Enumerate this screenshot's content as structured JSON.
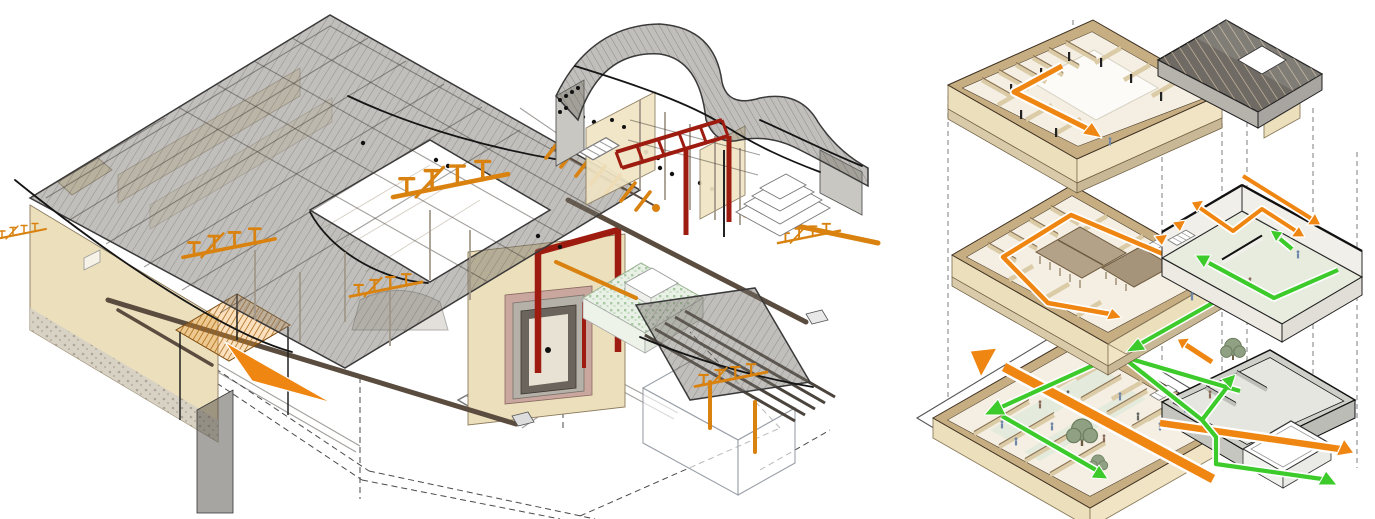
{
  "canvas": {
    "width": 1375,
    "height": 519,
    "viewbox": "0 0 1375 519"
  },
  "figures": {
    "left": {
      "id": "cutaway-axonometric",
      "kind": "sectional cutaway axonometric of a courtyard building",
      "elements": [
        "wireframe-tiled-roof",
        "tan-masonry-walls",
        "pebble-wall-base",
        "orange-timber-bracket-inserts",
        "orange-slatted-canopy",
        "orange-ramp",
        "dark-red-steel-frames",
        "green-mosaic-flat-roof",
        "ornamental-gate-wall",
        "curved-roof-hall",
        "stepped-plinth",
        "glass-gatehouse",
        "dashed-site-outline"
      ]
    },
    "right": {
      "id": "exploded-axonometric",
      "kind": "exploded axonometric with circulation arrows",
      "levels": [
        "upper-floor-plan",
        "courtyard-level-plan",
        "ground-level-plan"
      ],
      "extras": [
        "timber-roof-chunk",
        "mezzanine-box",
        "gray-annex",
        "white-court-box",
        "projection-dashed-lines",
        "trees",
        "people"
      ],
      "circulation": {
        "primary": "orange-route",
        "secondary": "green-route"
      }
    }
  },
  "colors": {
    "bg": "#ffffff",
    "ink": "#2f2f2f",
    "roof-fill": "rgba(118,112,106,0.45)",
    "roof-edge": "#3a3a3a",
    "wall-tan": "#ecdfbc",
    "wall-tan-dark": "#c7ad82",
    "wall-edge": "#8a7a5c",
    "timber-orange": "#d9820f",
    "arrow-orange": "#f08612",
    "orange-dark": "#a85e06",
    "steel-red": "#9e1b10",
    "arrow-green": "#3ccb2a",
    "green-dark": "#128a18",
    "gray-wall": "#c9c7c2",
    "glass": "rgba(255,255,255,0.62)",
    "glass-edge": "#9aa0a8",
    "beam-dark": "#5a4c3e",
    "slab-side": "#d9cbaa",
    "slab-side2": "#c9b896",
    "floor": "#f4efe2",
    "floor-green": "#e2eadb",
    "pav-roof": "#b3a188",
    "pav-roof2": "#a6947a",
    "chunk-dark": "#6f6a64",
    "chunk-gray": "#b6b2ac",
    "dash": "#8a8a8a",
    "tree": "#8fa083",
    "tree-dark": "#6c7d5f",
    "people": "#6f87a8",
    "mosaic-green": "#a9cba4"
  }
}
